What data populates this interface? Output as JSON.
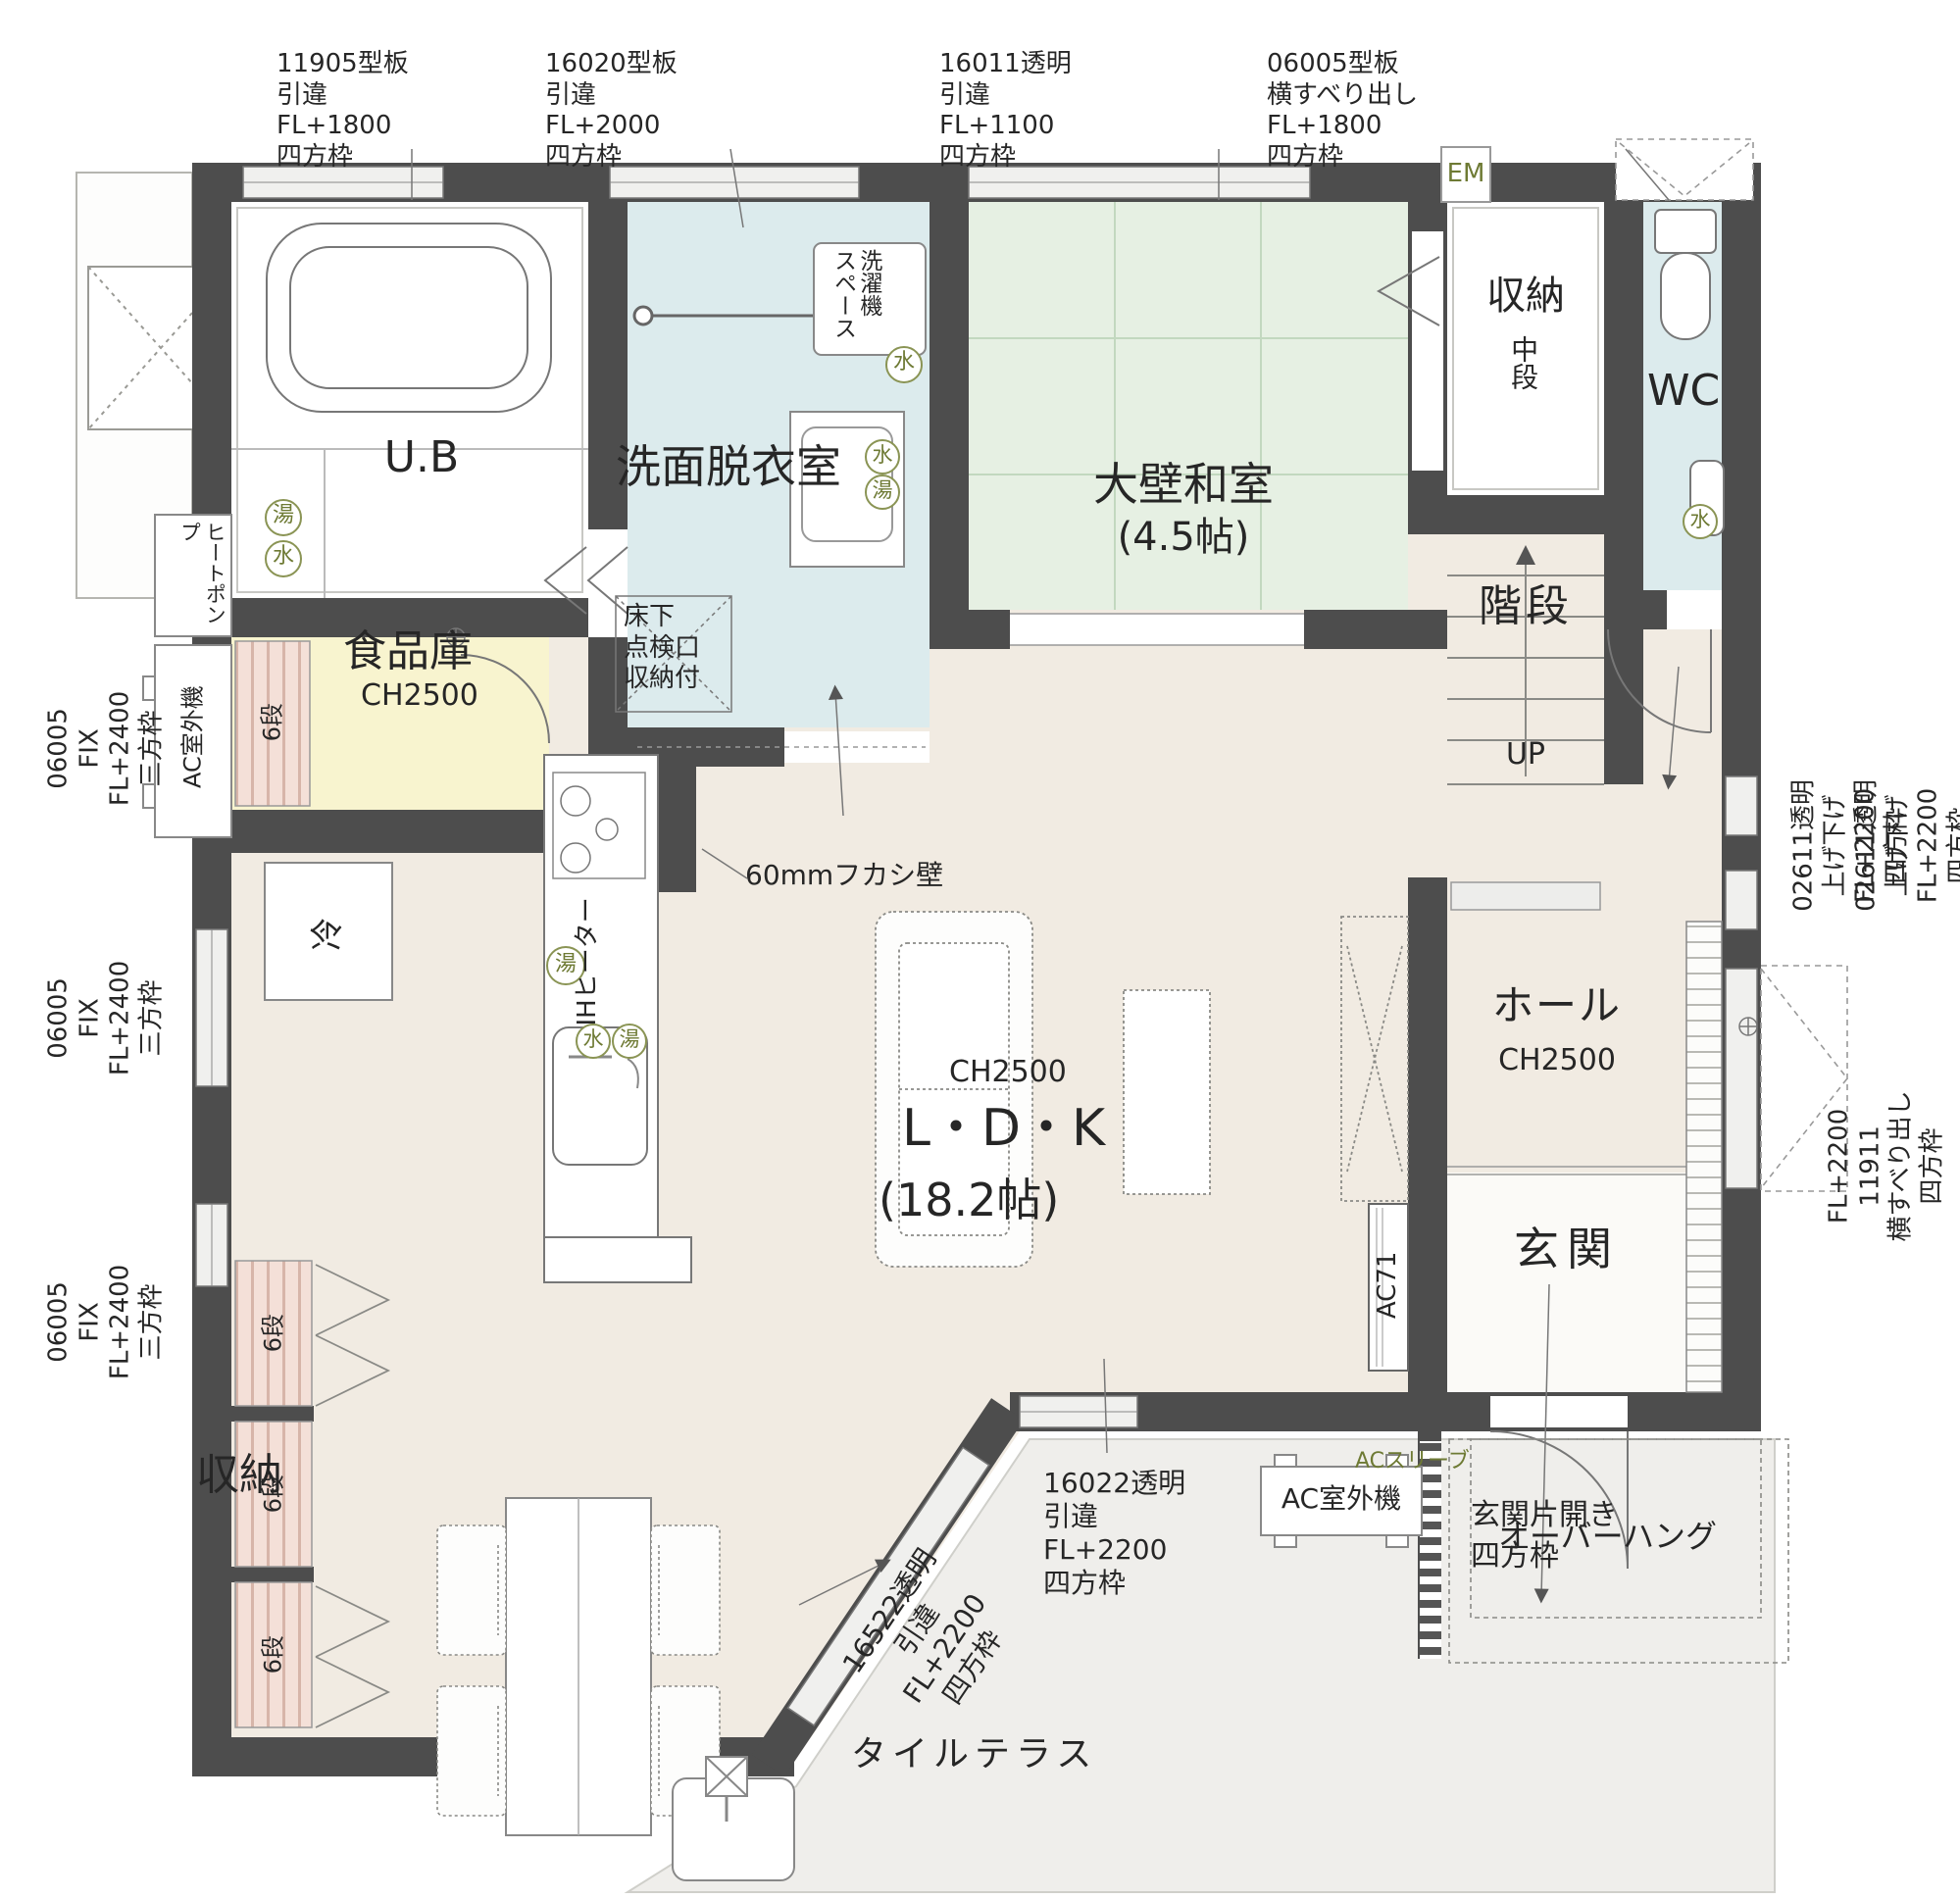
{
  "plan": {
    "labels": {
      "ub": "U.B",
      "senmen": "洗面脱衣室",
      "washitsu": "大壁和室",
      "washitsu_size": "(4.5帖)",
      "ldk": "L・D・K",
      "ldk_size": "(18.2帖)",
      "ch2500": "CH2500",
      "pantry": "食品庫",
      "hall": "ホール",
      "genkan": "玄関",
      "wc": "WC",
      "stairs": "階段",
      "up": "UP",
      "storage": "収納",
      "chudan": "中段",
      "dan6": "6段",
      "terrace": "タイルテラス",
      "rei": "冷"
    },
    "fixtures": {
      "laundry": "洗濯機\nスペース",
      "underfloor": "床下\n点検口\n収納付",
      "ih": "IHヒーター",
      "heat_pump": "ヒートポンプ",
      "ac_outdoor": "AC室外機",
      "ac_sleeve": "ACスリーブ",
      "ac71": "AC71",
      "fukashi": "60mmフカシ壁",
      "em": "EM",
      "water": "水",
      "hot": "湯",
      "door_note": "玄関片開き",
      "door_note2": "四方枠",
      "overhang": "オーバーハング"
    },
    "annotations": {
      "top": [
        {
          "text": "11905型板\n引違\nFL+1800\n四方枠"
        },
        {
          "text": "16020型板\n引違\nFL+2000\n四方枠"
        },
        {
          "text": "16011透明\n引違\nFL+1100\n四方枠"
        },
        {
          "text": "06005型板\n横すべり出し\nFL+1800\n四方枠"
        }
      ],
      "left": [
        {
          "text": "06005\nFIX\nFL+2400\n三方枠"
        },
        {
          "text": "06005\nFIX\nFL+2400\n三方枠"
        },
        {
          "text": "06005\nFIX\nFL+2400\n三方枠"
        }
      ],
      "right": [
        {
          "text": "02611透明\n上げ下げ\nFL+2200\n四方枠"
        },
        {
          "text": "02611透明\n上げ下げ\nFL+2200\n四方枠"
        },
        {
          "text": "FL+2200\n11911\n横すべり出し\n四方枠"
        }
      ],
      "bottom": [
        {
          "text": "16022透明\n引違\nFL+2200\n四方枠"
        },
        {
          "text": "16522透明\n引違\nFL+2200\n四方枠"
        }
      ]
    },
    "colors": {
      "wall": "#4d4d4d",
      "wet_room": "#dcebed",
      "tatami": "#e6f0e3",
      "pantry": "#f8f4cf",
      "floor": "#f1ebe2",
      "terrace": "#efeeeb",
      "shelf": "#f4e0d8",
      "accent_olive": "#6e7a34"
    }
  }
}
